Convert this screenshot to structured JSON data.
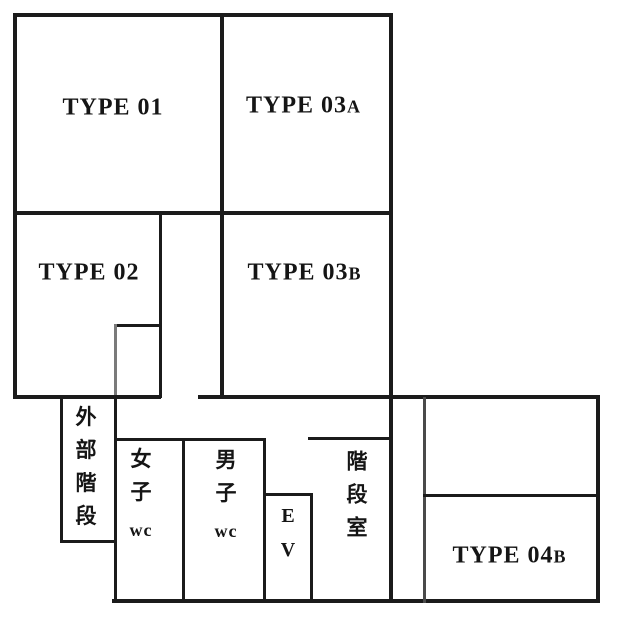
{
  "plan": {
    "title": "floor-plan",
    "colors": {
      "wall": "#1b1b1b",
      "background": "#ffffff"
    },
    "rooms": {
      "type01": {
        "label": "TYPE 01"
      },
      "type02": {
        "label": "TYPE 02"
      },
      "type03a": {
        "label": "TYPE 03",
        "suffix": "A"
      },
      "type03b": {
        "label": "TYPE 03",
        "suffix": "B"
      },
      "type04b": {
        "label": "TYPE 04",
        "suffix": "B"
      },
      "external_stair": {
        "label": "外部階段",
        "chars": [
          "外",
          "部",
          "階",
          "段"
        ]
      },
      "womens_wc": {
        "label": "女子wc",
        "chars": [
          "女",
          "子"
        ],
        "wc": "wc"
      },
      "mens_wc": {
        "label": "男子wc",
        "chars": [
          "男",
          "子"
        ],
        "wc": "wc"
      },
      "elevator": {
        "label": "EV",
        "chars": [
          "E",
          "V"
        ]
      },
      "stairwell": {
        "label": "階段室",
        "chars": [
          "階",
          "段",
          "室"
        ]
      }
    }
  }
}
